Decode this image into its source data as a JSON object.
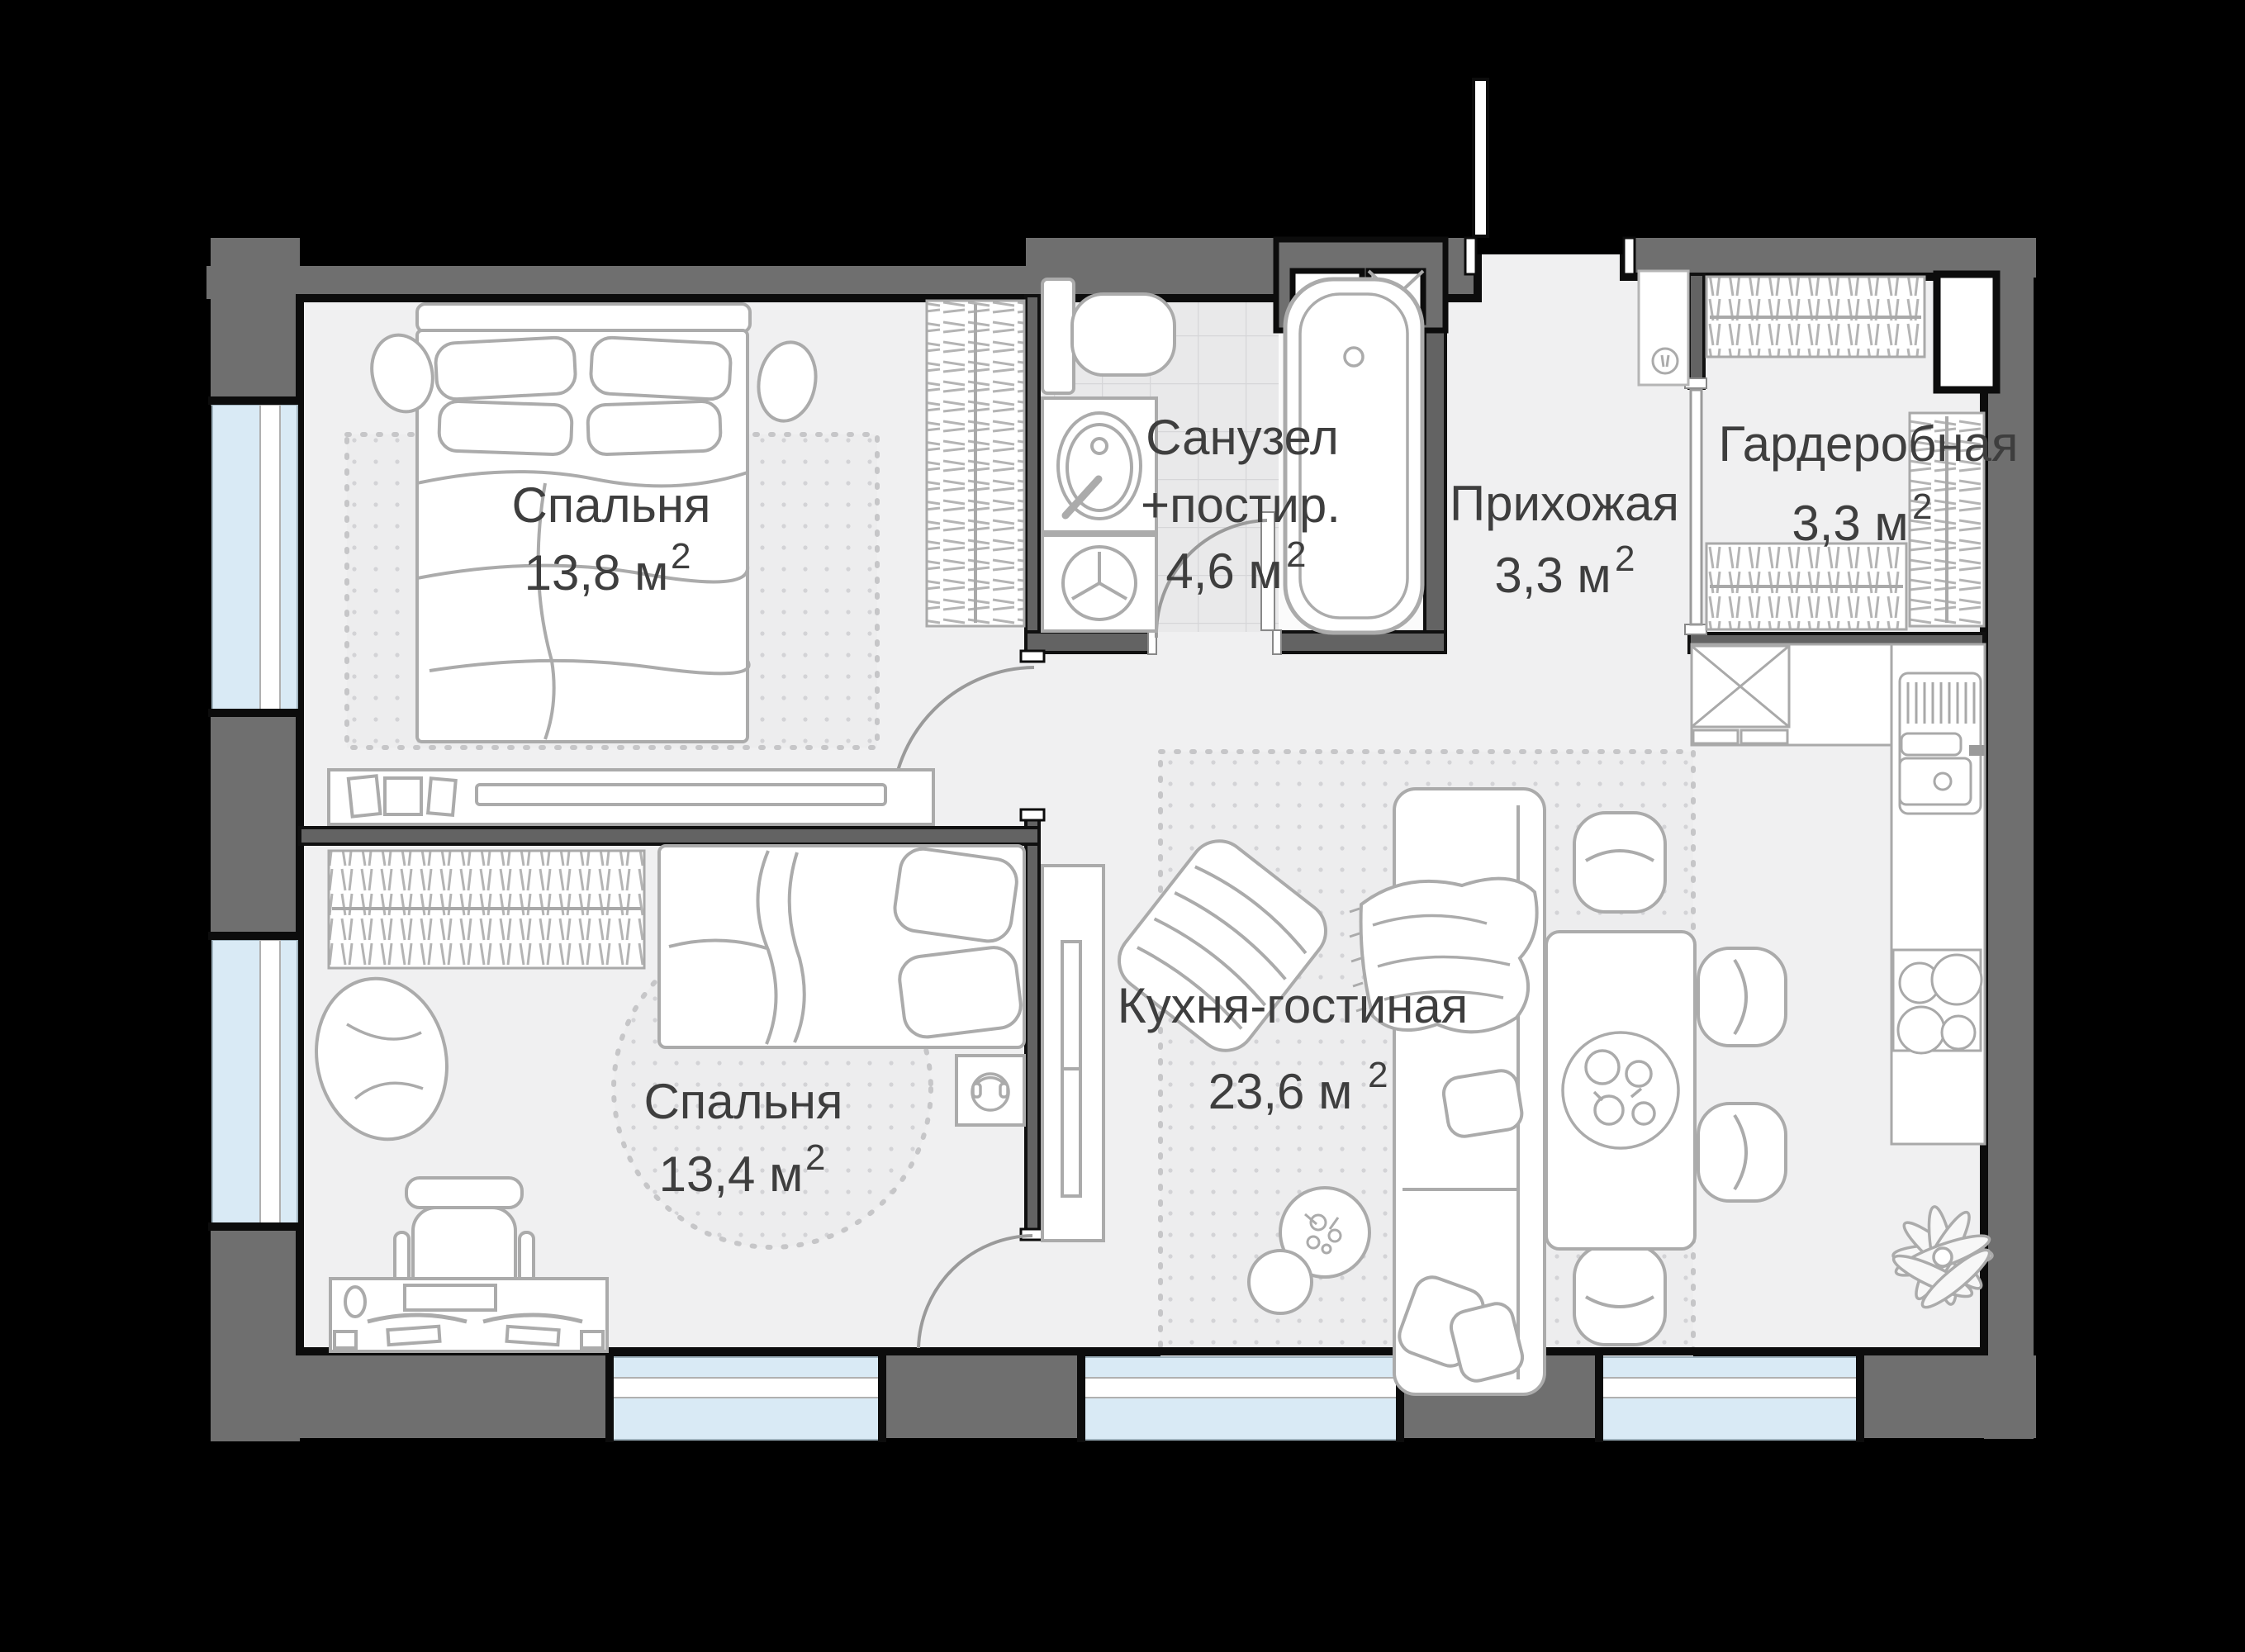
{
  "plan": {
    "type": "apartment-floor-plan",
    "background_color": "#000000",
    "wall_color": "#6f6f6f",
    "floor_color": "#f0f0f1",
    "window_glass_color": "#d9eaf5",
    "label_color": "#3e3e3e",
    "rooms": [
      {
        "id": "bedroom-1",
        "label": "Спальня",
        "label_line2": "",
        "area": "13,8 м",
        "area_sup": "2"
      },
      {
        "id": "bathroom",
        "label": "Санузел",
        "label_line2": "+постир.",
        "area": "4,6 м",
        "area_sup": "2"
      },
      {
        "id": "hallway",
        "label": "Прихожая",
        "label_line2": "",
        "area": "3,3 м",
        "area_sup": "2"
      },
      {
        "id": "wardrobe-room",
        "label": "Гардеробная",
        "label_line2": "",
        "area": "3,3 м",
        "area_sup": "2"
      },
      {
        "id": "kitchen-living",
        "label": "Кухня-гостиная",
        "label_line2": "",
        "area": "23,6 м",
        "area_sup": "2"
      },
      {
        "id": "bedroom-2",
        "label": "Спальня",
        "label_line2": "",
        "area": "13,4 м",
        "area_sup": "2"
      }
    ]
  }
}
